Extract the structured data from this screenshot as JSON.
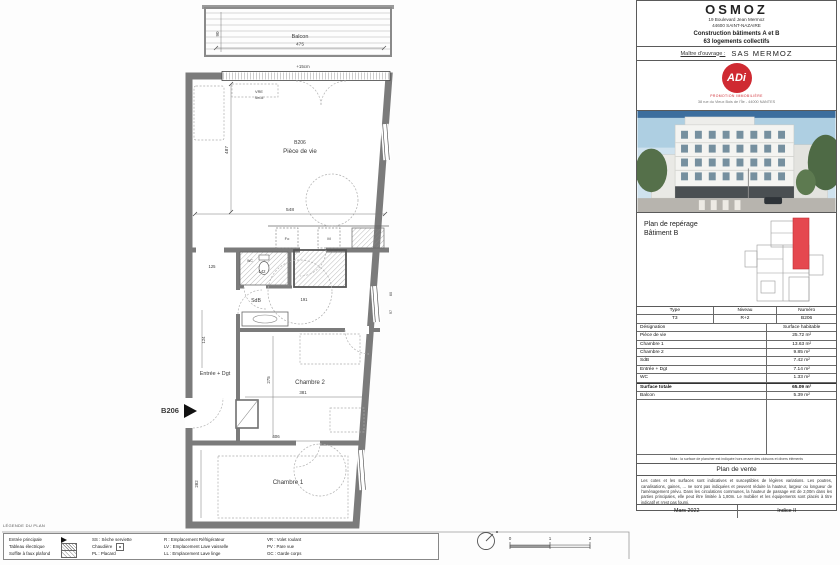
{
  "titleblock": {
    "name": "OSMOZ",
    "address1": "19 Boulevard Jean Mermoz",
    "address2": "44600 SAINT-NAZAIRE",
    "construction1": "Construction bâtiments A et B",
    "construction2": "63 logements collectifs",
    "mo_label": "Maître d'ouvrage :",
    "mo_value": "SAS MERMOZ",
    "logo": {
      "text": "ADi",
      "slogan": "PROMOTION IMMOBILIÈRE",
      "address": "38 rue du Vieux Bois de l'Île - 44000 NANTES"
    },
    "reperage1": "Plan de repérage",
    "reperage2": "Bâtiment B",
    "table": {
      "headers": [
        "Type",
        "Niveau",
        "Numéro"
      ],
      "values": [
        "T3",
        "R+2",
        "B206"
      ],
      "designation": "Désignation",
      "surface": "Surface habitable",
      "rows": [
        {
          "label": "Pièce de vie",
          "value": "25.72 m²"
        },
        {
          "label": "Chambre 1",
          "value": "13.63 m²"
        },
        {
          "label": "Chambre 2",
          "value": "9.85 m²"
        },
        {
          "label": "SdB",
          "value": "7.42 m²"
        },
        {
          "label": "Entrée + Dgt",
          "value": "7.14 m²"
        },
        {
          "label": "WC",
          "value": "1.33 m²"
        }
      ],
      "total_label": "Surface totale",
      "total_value": "65.09 m²",
      "balcon_label": "Balcon",
      "balcon_value": "5.39 m²"
    },
    "nota": "Nota : la surface de plancher est indiquée hors œuvre des cloisons et divers éléments",
    "plan_de_vente": "Plan de vente",
    "disclaimer": "Les cotes et les surfaces sont indicatives et susceptibles de légères variations. Les poutres, canalisations, gaines, ... ne sont pas indiquées et peuvent réduire la hauteur, largeur ou longueur de l'aménagement prévu. Dans les circulations communes, la hauteur de passage est de 2,00m dans les parties principales, elle peut être limitée à 1,80m. Le mobilier et les équipements sont placés à titre indicatif et n'est pas fourni.",
    "date": "Mars 2022",
    "indice": "Indice II"
  },
  "plan": {
    "rooms": {
      "piece_id": "B206",
      "piece": "Pièce de vie",
      "chambre1": "Chambre 1",
      "chambre2": "Chambre 2",
      "sdb": "SdB",
      "entree": "Entrée + Dgt",
      "balcon": "Balcon",
      "wc": "WC"
    },
    "unit_marker": "B206",
    "annotations": {
      "vre": "VRE",
      "seuil": "Seuil",
      "seuil_height": "+15cm",
      "four": "Fo",
      "micro": "M"
    },
    "dims": {
      "d475": "475",
      "d90": "90",
      "d548": "548",
      "d487": "487",
      "d125": "125",
      "d142": "142",
      "d191": "191",
      "d124": "124",
      "d381": "381",
      "d275": "275",
      "d406": "406",
      "d282": "282",
      "d60": "60",
      "d97": "97"
    },
    "scale_ticks": [
      "0",
      "1",
      "2"
    ]
  },
  "legend": {
    "title": "LÉGENDE DU PLAN",
    "col1": [
      "Entrée principale",
      "Tableau électrique",
      "Soffite à faux plafond"
    ],
    "col2": [
      "SS : Sèche serviette",
      "Chaudière",
      "PL : Placard"
    ],
    "col3": [
      "R : Emplacement Réfrigérateur",
      "LV : Emplacement Lave vaisselle",
      "LL : Emplacement Lave linge"
    ],
    "col4": [
      "VR : Volet roulant",
      "PV : Pare vue",
      "GC : Garde corps"
    ]
  }
}
